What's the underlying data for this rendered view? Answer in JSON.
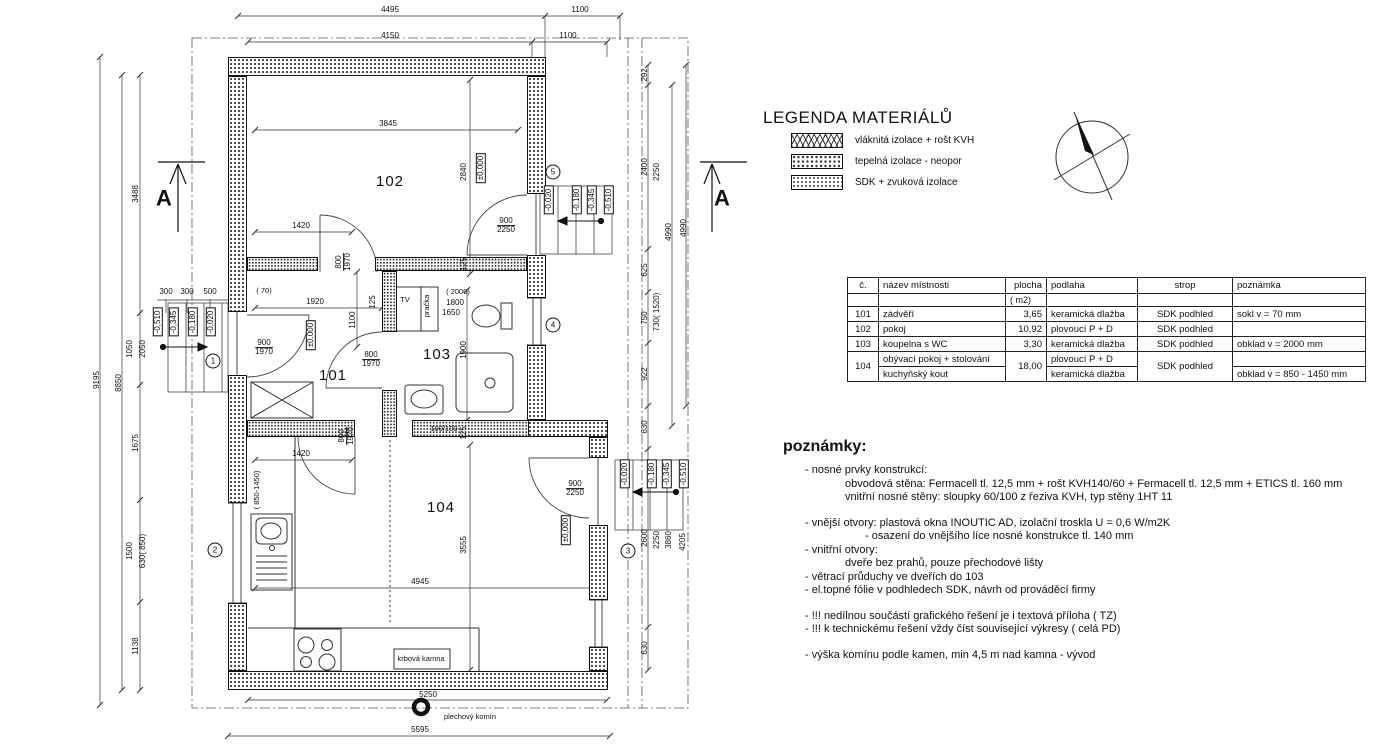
{
  "legend": {
    "title": "LEGENDA MATERIÁLŮ",
    "items": [
      {
        "pattern": "fiber",
        "label": "vláknitá izolace + rošt KVH"
      },
      {
        "pattern": "neopor",
        "label": "tepelná izolace - neopor"
      },
      {
        "pattern": "sdk",
        "label": "SDK + zvuková izolace"
      }
    ]
  },
  "compass": {
    "name": "north-arrow"
  },
  "room_table": {
    "headers": {
      "num": "č.",
      "name": "název místnosti",
      "area": "plocha",
      "area_unit": "(  m2)",
      "floor": "podlaha",
      "ceiling": "strop",
      "note": "poznámka"
    },
    "rows": [
      {
        "num": "101",
        "name": "zádvěří",
        "area": "3,65",
        "floor": "keramická dlažba",
        "ceiling": "SDK podhled",
        "note": "sokl v = 70 mm"
      },
      {
        "num": "102",
        "name": "pokoj",
        "area": "10,92",
        "floor": "plovoucí P + D",
        "ceiling": "SDK podhled",
        "note": ""
      },
      {
        "num": "103",
        "name": "koupelna s WC",
        "area": "3,30",
        "floor": "keramická dlažba",
        "ceiling": "SDK podhled",
        "note": "obklad v = 2000 mm"
      }
    ],
    "row104": {
      "num": "104",
      "name1": "obývací pokoj + stolování",
      "name2": "kuchyňský kout",
      "area": "18,00",
      "floor1": "plovoucí P + D",
      "floor2": "keramická dlažba",
      "ceiling": "SDK podhled",
      "note1": "",
      "note2": "obklad v = 850 - 1450 mm"
    }
  },
  "notes": {
    "title": "poznámky:",
    "lines": [
      {
        "text": "- nosné prvky konstrukcí:",
        "indent": 1,
        "gap": 0
      },
      {
        "text": "obvodová stěna: Fermacell tl. 12,5 mm + rošt KVH140/60 + Fermacell tl. 12,5 mm + ETICS tl. 160 mm",
        "indent": 2,
        "gap": 0
      },
      {
        "text": "vnitřní nosné stěny: sloupky 60/100 z řeziva KVH, typ stěny 1HT 11",
        "indent": 2,
        "gap": 0
      },
      {
        "text": "- vnější otvory:  plastová okna INOUTIC AD, izolační troskla U = 0,6 W/m2K",
        "indent": 1,
        "gap": 1
      },
      {
        "text": "- osazení do vnějšího líce nosné konstrukce tl. 140 mm",
        "indent": 3,
        "gap": 0
      },
      {
        "text": "- vnitřní otvory:",
        "indent": 1,
        "gap": 0
      },
      {
        "text": "dveře bez prahů, pouze přechodové lišty",
        "indent": 2,
        "gap": 0
      },
      {
        "text": "- větrací průduchy ve dveřích do 103",
        "indent": 1,
        "gap": 0
      },
      {
        "text": "- el.topné fólie v podhledech SDK, návrh od prováděcí firmy",
        "indent": 1,
        "gap": 0
      },
      {
        "text": "- !!!  nedílnou součástí grafického řešení je i textová příloha (  TZ)",
        "indent": 1,
        "gap": 1
      },
      {
        "text": "- !!! k technickému řešení vždy číst související výkresy (  celá PD)",
        "indent": 1,
        "gap": 0
      },
      {
        "text": "- výška komínu podle kamen, min 4,5 m nad kamna - vývod",
        "indent": 1,
        "gap": 1
      }
    ]
  },
  "plan": {
    "labels": [
      {
        "t": "4495",
        "x": 390,
        "y": 10
      },
      {
        "t": "1100",
        "x": 580,
        "y": 10
      },
      {
        "t": "4150",
        "x": 390,
        "y": 36
      },
      {
        "t": "1100",
        "x": 568,
        "y": 36
      },
      {
        "t": "9195",
        "x": 97,
        "y": 380,
        "r": -90
      },
      {
        "t": "8850",
        "x": 119,
        "y": 383,
        "r": -90
      },
      {
        "t": "3488",
        "x": 136,
        "y": 194,
        "r": -90
      },
      {
        "t": "1050",
        "x": 130,
        "y": 349,
        "r": -90
      },
      {
        "t": "2050",
        "x": 143,
        "y": 349,
        "r": -90
      },
      {
        "t": "1675",
        "x": 136,
        "y": 443,
        "r": -90
      },
      {
        "t": "1500",
        "x": 130,
        "y": 551,
        "r": -90
      },
      {
        "t": "630( 850)",
        "x": 143,
        "y": 551,
        "r": -90
      },
      {
        "t": "1138",
        "x": 136,
        "y": 646,
        "r": -90
      },
      {
        "t": "300",
        "x": 166,
        "y": 292
      },
      {
        "t": "300",
        "x": 187,
        "y": 292
      },
      {
        "t": "500",
        "x": 210,
        "y": 292
      },
      {
        "t": "-0,510",
        "x": 158,
        "y": 322,
        "r": -90,
        "s": "box"
      },
      {
        "t": "-0,345",
        "x": 174,
        "y": 322,
        "r": -90,
        "s": "box"
      },
      {
        "t": "-0,180",
        "x": 193,
        "y": 322,
        "r": -90,
        "s": "box"
      },
      {
        "t": "-0,020",
        "x": 211,
        "y": 322,
        "r": -90,
        "s": "box"
      },
      {
        "t": "900|1970",
        "x": 264,
        "y": 348,
        "s": "frac"
      },
      {
        "t": "1",
        "x": 213,
        "y": 361,
        "s": "circle"
      },
      {
        "t": "2",
        "x": 215,
        "y": 550,
        "s": "circle"
      },
      {
        "t": "292",
        "x": 645,
        "y": 75,
        "r": -90
      },
      {
        "t": "2400",
        "x": 645,
        "y": 167,
        "r": -90
      },
      {
        "t": "2250",
        "x": 657,
        "y": 172,
        "r": -90
      },
      {
        "t": "4990",
        "x": 669,
        "y": 232,
        "r": -90
      },
      {
        "t": "4990",
        "x": 684,
        "y": 228,
        "r": -90
      },
      {
        "t": "625",
        "x": 645,
        "y": 270,
        "r": -90
      },
      {
        "t": "750",
        "x": 645,
        "y": 318,
        "r": -90
      },
      {
        "t": "730( 1520)",
        "x": 657,
        "y": 312,
        "r": -90
      },
      {
        "t": "922",
        "x": 645,
        "y": 374,
        "r": -90
      },
      {
        "t": "630",
        "x": 645,
        "y": 427,
        "r": -90
      },
      {
        "t": "2600",
        "x": 645,
        "y": 538,
        "r": -90
      },
      {
        "t": "2250",
        "x": 657,
        "y": 540,
        "r": -90
      },
      {
        "t": "3860",
        "x": 669,
        "y": 540,
        "r": -90
      },
      {
        "t": "4205",
        "x": 683,
        "y": 542,
        "r": -90
      },
      {
        "t": "630",
        "x": 645,
        "y": 648,
        "r": -90
      },
      {
        "t": "-0,020",
        "x": 549,
        "y": 200,
        "r": -90,
        "s": "box"
      },
      {
        "t": "-0,180",
        "x": 577,
        "y": 200,
        "r": -90,
        "s": "box"
      },
      {
        "t": "-0,345",
        "x": 592,
        "y": 200,
        "r": -90,
        "s": "box"
      },
      {
        "t": "-0,510",
        "x": 609,
        "y": 200,
        "r": -90,
        "s": "box"
      },
      {
        "t": "-0,020",
        "x": 625,
        "y": 474,
        "r": -90,
        "s": "box"
      },
      {
        "t": "-0,180",
        "x": 652,
        "y": 474,
        "r": -90,
        "s": "box"
      },
      {
        "t": "-0,345",
        "x": 667,
        "y": 474,
        "r": -90,
        "s": "box"
      },
      {
        "t": "-0,510",
        "x": 684,
        "y": 474,
        "r": -90,
        "s": "box"
      },
      {
        "t": "3",
        "x": 628,
        "y": 551,
        "s": "circle"
      },
      {
        "t": "4",
        "x": 553,
        "y": 325,
        "s": "circle"
      },
      {
        "t": "5",
        "x": 553,
        "y": 172,
        "s": "circle"
      },
      {
        "t": "A",
        "x": 164,
        "y": 198,
        "s": "sec"
      },
      {
        "t": "A",
        "x": 722,
        "y": 198,
        "s": "sec"
      },
      {
        "t": "5250",
        "x": 428,
        "y": 695
      },
      {
        "t": "5595",
        "x": 420,
        "y": 730
      },
      {
        "t": "plechový komín",
        "x": 470,
        "y": 717,
        "s": "small"
      },
      {
        "t": "3845",
        "x": 388,
        "y": 124
      },
      {
        "t": "2840",
        "x": 464,
        "y": 172,
        "r": -90
      },
      {
        "t": "102",
        "x": 390,
        "y": 182,
        "s": "room"
      },
      {
        "t": "1420",
        "x": 301,
        "y": 226
      },
      {
        "t": "800|1970",
        "x": 344,
        "y": 262,
        "r": -90,
        "s": "frac"
      },
      {
        "t": "125",
        "x": 464,
        "y": 264,
        "r": -90
      },
      {
        "t": "900|2250",
        "x": 506,
        "y": 226,
        "s": "frac"
      },
      {
        "t": "±0,000",
        "x": 481,
        "y": 168,
        "r": -90,
        "s": "box"
      },
      {
        "t": "( 70)",
        "x": 264,
        "y": 291,
        "s": "small"
      },
      {
        "t": "1920",
        "x": 315,
        "y": 302
      },
      {
        "t": "125",
        "x": 373,
        "y": 302,
        "r": -90
      },
      {
        "t": "TV",
        "x": 405,
        "y": 300,
        "s": "small"
      },
      {
        "t": "pračka",
        "x": 427,
        "y": 306,
        "r": -90,
        "s": "small"
      },
      {
        "t": "( 2000)",
        "x": 458,
        "y": 292,
        "s": "small"
      },
      {
        "t": "1800",
        "x": 455,
        "y": 303
      },
      {
        "t": "1650",
        "x": 451,
        "y": 313
      },
      {
        "t": "1100",
        "x": 353,
        "y": 320,
        "r": -90
      },
      {
        "t": "800|1970",
        "x": 371,
        "y": 360,
        "s": "frac"
      },
      {
        "t": "±0,000",
        "x": 311,
        "y": 335,
        "r": -90,
        "s": "box"
      },
      {
        "t": "101",
        "x": 333,
        "y": 376,
        "s": "room"
      },
      {
        "t": "103",
        "x": 437,
        "y": 355,
        "s": "room"
      },
      {
        "t": "1900",
        "x": 464,
        "y": 350,
        "r": -90
      },
      {
        "t": "100/100",
        "x": 444,
        "y": 429,
        "s": "small"
      },
      {
        "t": "125",
        "x": 464,
        "y": 433,
        "r": -90
      },
      {
        "t": "800|1970",
        "x": 347,
        "y": 436,
        "r": -90,
        "s": "frac"
      },
      {
        "t": "1420",
        "x": 301,
        "y": 454
      },
      {
        "t": "104",
        "x": 441,
        "y": 508,
        "s": "room"
      },
      {
        "t": "3555",
        "x": 464,
        "y": 545,
        "r": -90
      },
      {
        "t": "4945",
        "x": 420,
        "y": 582
      },
      {
        "t": "900|2250",
        "x": 575,
        "y": 489,
        "s": "frac"
      },
      {
        "t": "±0,000",
        "x": 566,
        "y": 530,
        "r": -90,
        "s": "box"
      },
      {
        "t": "( 850-1450)",
        "x": 257,
        "y": 490,
        "r": -90,
        "s": "small"
      },
      {
        "t": "krbová kamna",
        "x": 421,
        "y": 659,
        "s": "small"
      }
    ]
  }
}
